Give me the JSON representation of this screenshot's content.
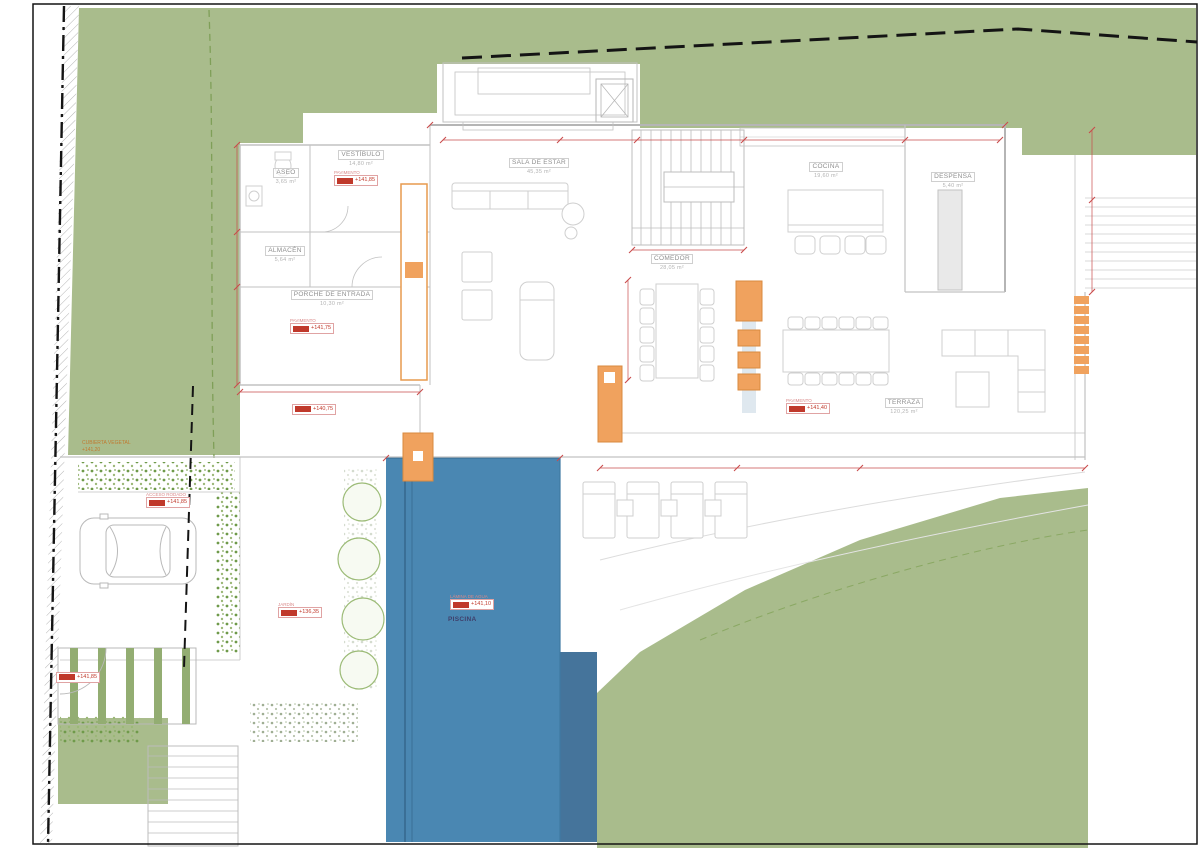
{
  "sheet": {
    "type": "architectural-floor-plan",
    "level": "planta baja"
  },
  "rooms": [
    {
      "name": "ASEO",
      "area": "3,65 m²"
    },
    {
      "name": "VESTÍBULO",
      "area": "14,80 m²"
    },
    {
      "name": "ALMACÉN",
      "area": "5,64 m²"
    },
    {
      "name": "PORCHE DE ENTRADA",
      "area": "10,30 m²"
    },
    {
      "name": "SALA DE ESTAR",
      "area": "45,35 m²"
    },
    {
      "name": "COCINA",
      "area": "19,60 m²"
    },
    {
      "name": "DESPENSA",
      "area": "5,40 m²"
    },
    {
      "name": "COMEDOR",
      "area": "28,05 m²"
    },
    {
      "name": "TERRAZA",
      "area": "120,25 m²"
    },
    {
      "name": "PISCINA",
      "area": ""
    }
  ],
  "markers": [
    {
      "title": "PAVIMENTO",
      "value": "+141,85"
    },
    {
      "title": "PAVIMENTO",
      "value": "+141,75"
    },
    {
      "title": "",
      "value": "+140,75"
    },
    {
      "title": "PAVIMENTO",
      "value": "+141,40"
    },
    {
      "title": "LÁMINA DE AGUA",
      "value": "+141,10"
    },
    {
      "title": "ACCESO RODADO",
      "value": "+141,85"
    },
    {
      "title": "",
      "value": "+141,85"
    },
    {
      "title": "JARDÍN",
      "value": "+136,35"
    }
  ],
  "notes": {
    "green_note_line1": "CUBIERTA VEGETAL",
    "green_note_line2": "+141,20"
  },
  "colors": {
    "landscape_green": "#a9bc8c",
    "pool_blue": "#4a87b2",
    "pool_blue_dark": "#45749b",
    "planter_orange": "#f0a25e",
    "dimension_red": "#c94b4b",
    "boundary_black": "#141414",
    "wall_gray": "#c6c6c6"
  }
}
